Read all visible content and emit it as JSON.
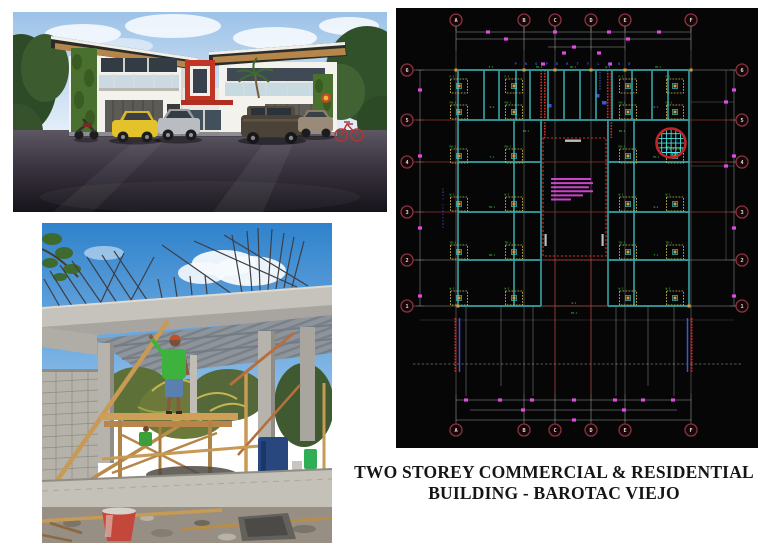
{
  "page": {
    "width": 768,
    "height": 550,
    "background": "#ffffff"
  },
  "title": {
    "line1": "TWO STOREY COMMERCIAL & RESIDENTIAL",
    "line2": "BUILDING - BAROTAC VIEJO",
    "color": "#151515"
  },
  "floor_plan": {
    "grid_columns": [
      "A",
      "B",
      "C",
      "D",
      "E",
      "F"
    ],
    "grid_rows": [
      "6",
      "5",
      "4",
      "3",
      "2",
      "1"
    ],
    "property_line_label": "PROPERTY LINE",
    "micro_labels": [
      "F-1",
      "FW-1",
      "PW-1",
      "W-1",
      "TB-1",
      "W-2"
    ],
    "colors": {
      "background": "#060607",
      "wall": "#4ae2e2",
      "grid": "#a9afae",
      "row": "#7c2a2a",
      "bubble_ring": "#8c3240",
      "bubble_fill": "#150607",
      "bubble_text": "#e6dada",
      "footing": "#d6c25e",
      "node": "#dd9a2f",
      "label": "#3bcf45",
      "dimension": "#e04ae0",
      "red": "#d22f27",
      "blue": "#4053d6",
      "note": "#e04ae0",
      "white": "#cfd0d0"
    }
  },
  "exterior_render": {
    "sky": "#a9c9ea",
    "building_white": "#f3f2ed",
    "roof_dark": "#2b2b28",
    "wood_soffit": "#b5854a",
    "greenery": "#4a7030",
    "accent_red": "#c23424",
    "asphalt": "#2a2630",
    "car_yellow": "#e3c22c",
    "car_silver": "#b9bdc1",
    "car_brown": "#4b4238"
  },
  "construction_photo": {
    "sky": "#3f8ed3",
    "concrete": "#c6c3bc",
    "deck_gray": "#8d949b",
    "wood_tan": "#c79a55",
    "shirt_green": "#3db23d",
    "shorts_blue": "#5b7fae",
    "bucket_red": "#c4473c",
    "drum_blue": "#27477e"
  }
}
